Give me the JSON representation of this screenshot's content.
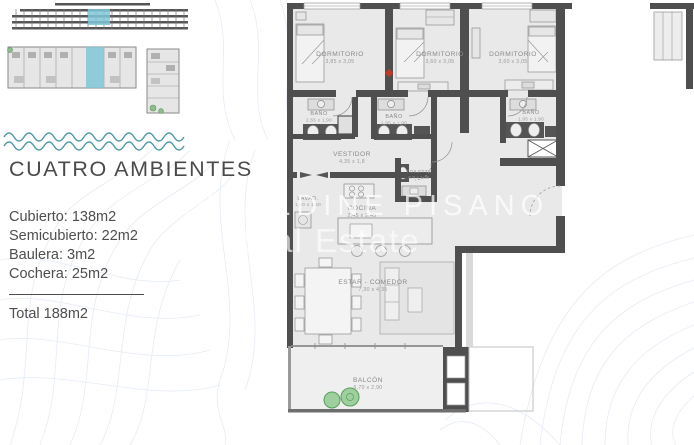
{
  "info_panel": {
    "title": "CUATRO AMBIENTES",
    "lines": [
      "Cubierto: 138m2",
      "Semicubierto: 22m2",
      "Baulera: 3m2",
      "Cochera: 25m2"
    ],
    "total": "Total 188m2"
  },
  "watermark": {
    "line1": "GERALDINE PISANO",
    "line2": "Real Estate"
  },
  "floor_plan": {
    "rooms": [
      {
        "name": "DORMITORIO",
        "dims": "3,85 x 3,05"
      },
      {
        "name": "DORMITORIO",
        "dims": "3,60 x 3,05"
      },
      {
        "name": "DORMITORIO",
        "dims": "3,60 x 3,05"
      },
      {
        "name": "BAÑO",
        "dims": "2,55 x 1,90"
      },
      {
        "name": "BAÑO",
        "dims": "1,95 x 1,90"
      },
      {
        "name": "BAÑO",
        "dims": "1,95 x 1,90"
      },
      {
        "name": "VESTIDOR",
        "dims": "4,35 x 1,8"
      },
      {
        "name": "TOILETTE",
        "dims": "0,9 x 1,35"
      },
      {
        "name": "LAVAD.",
        "dims": "1,50 x 1,60"
      },
      {
        "name": "COCINA",
        "dims": "2,45 x 2,45"
      },
      {
        "name": "ESTAR - COMEDOR",
        "dims": "7,30 x 4,35"
      },
      {
        "name": "BALCÓN",
        "dims": "6,70 x 2,90"
      }
    ],
    "colors": {
      "wall": "#4f4f4f",
      "floor": "#e9e9e9",
      "highlight_cyan": "#7fc6d6",
      "plant_green": "#8fc98f",
      "marker_red": "#c0392b",
      "contour_blue": "#ccd9ec",
      "wave_teal": "#4f9aa8"
    }
  }
}
